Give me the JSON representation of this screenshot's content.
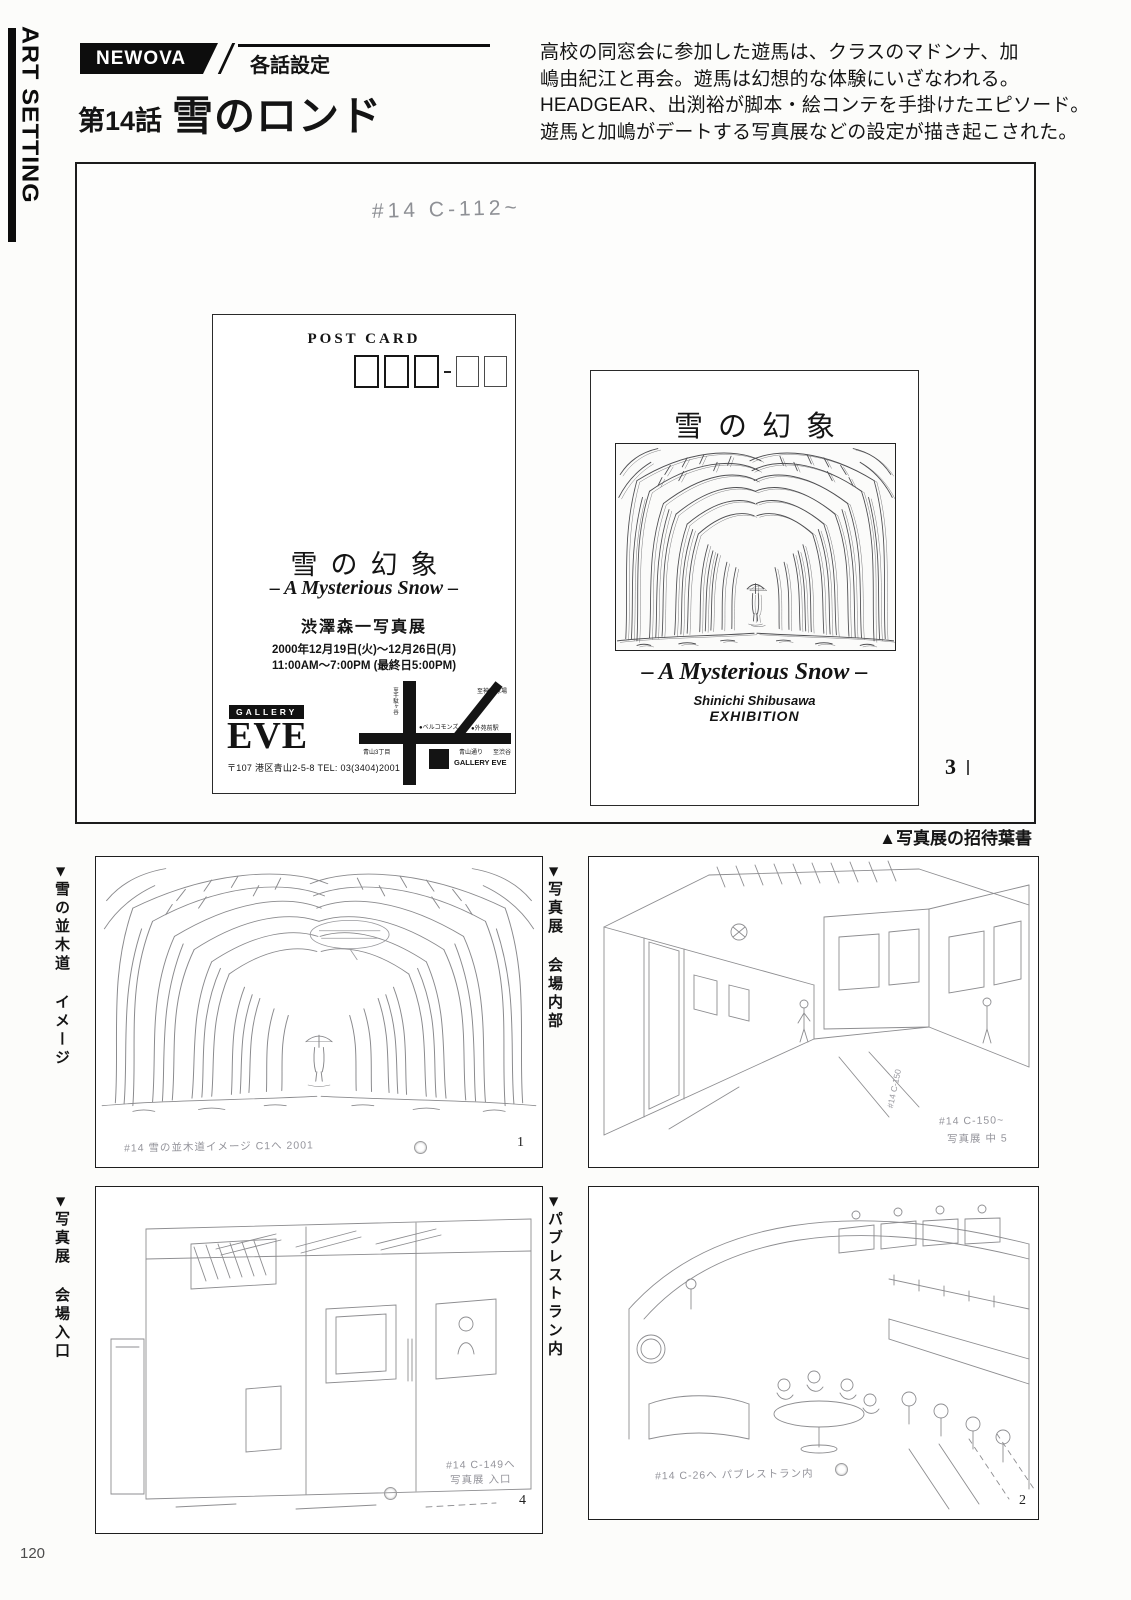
{
  "page": {
    "sidebar_label": "ART SETTING",
    "page_number": "120"
  },
  "header": {
    "series_badge": "NEWOVA",
    "section_label": "各話設定",
    "episode_number": "第14話",
    "episode_title": "雪のロンド",
    "synopsis_lines": [
      "高校の同窓会に参加した遊馬は、クラスのマドンナ、加",
      "嶋由紀江と再会。遊馬は幻想的な体験にいざなわれる。",
      "HEADGEAR、出渕裕が脚本・絵コンテを手掛けたエピソード。",
      "遊馬と加嶋がデートする写真展などの設定が描き起こされた。"
    ]
  },
  "plate": {
    "handwritten_note": "#14 C-112~",
    "plate_number": "3",
    "caption": "▲写真展の招待葉書",
    "postcard_front": {
      "header": "POST CARD",
      "title": "雪の幻象",
      "subtitle": "– A Mysterious Snow –",
      "exhibition": "渋澤森一写真展",
      "dates": "2000年12月19日(火)～12月26日(月)",
      "hours": "11:00AM～7:00PM (最終日5:00PM)",
      "gallery_label": "GALLERY",
      "gallery_name": "EVE",
      "address": "〒107 港区青山2-5-8 TEL: 03(3404)2001",
      "map": {
        "to_sendagaya": "至千駄ヶ谷",
        "bell_commons": "●ベルコモンズ",
        "to_jingu_stadium": "至神宮球場",
        "gaienmae_station": "●外苑前駅",
        "aoyama_3chome": "青山3丁目",
        "aoyama_dori": "青山通り",
        "to_shibuya": "至渋谷",
        "gallery_marker": "GALLERY EVE"
      }
    },
    "postcard_back": {
      "title": "雪の幻象",
      "subtitle": "– A Mysterious Snow –",
      "artist": "Shinichi Shibusawa",
      "exhibition_word": "EXHIBITION"
    }
  },
  "panels": [
    {
      "marker": "▶",
      "caption": "雪の並木道 イメージ",
      "note": "#14 雪の並木道イメージ C1へ 2001",
      "number": "1"
    },
    {
      "marker": "▶",
      "caption": "写真展 会場内部",
      "note": "#14 C-150~",
      "note2": "写真展 中 5",
      "side_note": "#14 C-150"
    },
    {
      "marker": "▶",
      "caption": "写真展 会場入口",
      "note": "#14 C-149へ",
      "note2": "写真展 入口",
      "number": "4"
    },
    {
      "marker": "▶",
      "caption": "パブレストラン内",
      "note": "#14 C-26へ パブレストラン内",
      "number": "2"
    }
  ]
}
